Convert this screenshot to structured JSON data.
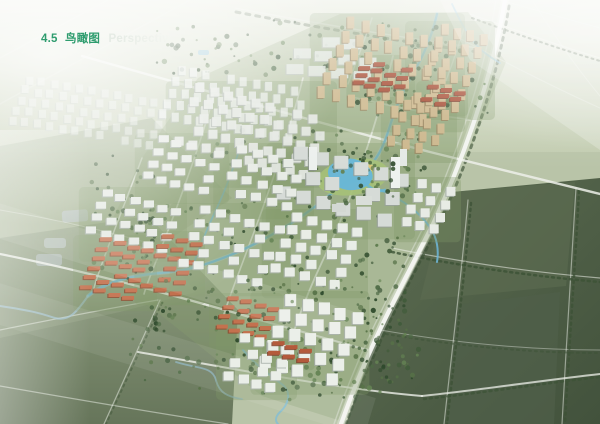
{
  "title": {
    "section": "4.5",
    "zh": "鸟瞰图",
    "en": "Perspective"
  },
  "image": {
    "description": "Hazy aerial bird's-eye perspective rendering of a new-town residential master plan: white and beige high-rise clusters, red- and salmon-roofed row houses, winding blue canals, a central civic core with lake park, a curved white bypass road, surrounded by green farmland with faint field roads"
  },
  "palette": {
    "title_green": "#2e9c6e",
    "title_en_gray": "#e2e9e2",
    "haze_white": "#ffffff",
    "field_light": "#c6d0b8",
    "field_medium": "#8a9a7c",
    "field_dark": "#4c5c45",
    "water_blue": "#6fb9dc",
    "road_white": "#edf0ea",
    "tree_green": "#4e6a45",
    "white_building": "#e7ebe5",
    "beige_building": "#cdb88d",
    "red_roof": "#a84f36",
    "salmon_roof": "#c4714e",
    "park_lawn": "#a6c178",
    "park_sand": "#d7c271"
  },
  "scene": {
    "tree_palette": [
      "#4e6a45",
      "#3f5a39",
      "#648253",
      "#2f4a2c",
      "#577247"
    ],
    "clusters": [
      {
        "name": "distant-city-west",
        "x": 26,
        "y": 76,
        "cols": 12,
        "rows": 5,
        "sx": 12.5,
        "sy": 10,
        "bw": 7,
        "bh": 8,
        "color": "#e9ede9",
        "shade": "#b6bfba",
        "op": 0.55,
        "rise": 0.18,
        "skip": 0.06,
        "lawn": false
      },
      {
        "name": "distant-city-east",
        "x": 178,
        "y": 66,
        "cols": 11,
        "rows": 5,
        "sx": 12.5,
        "sy": 11,
        "bw": 7,
        "bh": 9,
        "color": "#eaeeea",
        "shade": "#b2bbb5",
        "op": 0.75,
        "rise": 0.18,
        "skip": 0.08,
        "lawn": false
      },
      {
        "name": "industrial-sheds",
        "x": 300,
        "y": 34,
        "cols": 4,
        "rows": 3,
        "sx": 22,
        "sy": 15,
        "bw": 17,
        "bh": 10,
        "color": "#e2e7e1",
        "shade": "#b8c0ba",
        "op": 0.85,
        "rise": 0.12,
        "lawn": false
      },
      {
        "name": "beige-towers-north",
        "x": 348,
        "y": 16,
        "cols": 8,
        "rows": 6,
        "sx": 14.5,
        "sy": 14,
        "bw": 7,
        "bh": 12,
        "color": "#cdb88d",
        "shade": "#97815c",
        "op": 1
      },
      {
        "name": "redroof-rows-north",
        "x": 362,
        "y": 58,
        "cols": 4,
        "rows": 4,
        "sx": 13,
        "sy": 7.5,
        "bw": 11,
        "bh": 4,
        "color": "#a84f36",
        "shade": "#7c3a28",
        "op": 1
      },
      {
        "name": "beige-towers-east",
        "x": 442,
        "y": 24,
        "cols": 4,
        "rows": 6,
        "sx": 13,
        "sy": 13.5,
        "bw": 7,
        "bh": 11,
        "color": "#cdb88d",
        "shade": "#97815c",
        "op": 1
      },
      {
        "name": "redroof-rows-east",
        "x": 428,
        "y": 84,
        "cols": 3,
        "rows": 3,
        "sx": 13,
        "sy": 7,
        "bw": 11,
        "bh": 4,
        "color": "#a84f36",
        "shade": "#7c3a28",
        "op": 1
      },
      {
        "name": "beige-towers-mid",
        "x": 404,
        "y": 100,
        "cols": 4,
        "rows": 4,
        "sx": 13,
        "sy": 12,
        "bw": 7,
        "bh": 10,
        "color": "#cbb68b",
        "shade": "#97815c",
        "op": 1
      },
      {
        "name": "white-blocks-mid",
        "x": 196,
        "y": 84,
        "cols": 10,
        "rows": 5,
        "sx": 14,
        "sy": 13,
        "bw": 9,
        "bh": 9,
        "color": "#e3e7e1",
        "shade": "#aab2ac",
        "op": 0.95
      },
      {
        "name": "civic-core-blocks",
        "x": 294,
        "y": 146,
        "cols": 6,
        "rows": 3,
        "sx": 20,
        "sy": 20,
        "bw": 14,
        "bh": 13,
        "color": "#d6dbd7",
        "shade": "#99a19b",
        "op": 1
      },
      {
        "name": "white-res-a",
        "x": 158,
        "y": 136,
        "cols": 5,
        "rows": 4,
        "sx": 14,
        "sy": 12,
        "bw": 10,
        "bh": 7,
        "color": "#e5e9e3",
        "shade": "#a9b1ab",
        "op": 1
      },
      {
        "name": "white-res-b",
        "x": 238,
        "y": 146,
        "cols": 5,
        "rows": 4,
        "sx": 15,
        "sy": 13,
        "bw": 10,
        "bh": 8,
        "color": "#e7ebe5",
        "shade": "#a9b1ab",
        "op": 1
      },
      {
        "name": "white-res-c",
        "x": 102,
        "y": 190,
        "cols": 6,
        "rows": 4,
        "sx": 14,
        "sy": 12,
        "bw": 10,
        "bh": 7,
        "color": "#e5e9e3",
        "shade": "#a9b1ab",
        "op": 1
      },
      {
        "name": "salmon-rows-a",
        "x": 100,
        "y": 238,
        "cols": 4,
        "rows": 6,
        "sx": 14,
        "sy": 9.5,
        "bw": 12,
        "bh": 4,
        "color": "#c4714e",
        "shade": "#8f4a2f",
        "op": 1
      },
      {
        "name": "salmon-rows-b",
        "x": 162,
        "y": 234,
        "cols": 3,
        "rows": 6,
        "sx": 14,
        "sy": 9.8,
        "bw": 12,
        "bh": 4,
        "color": "#c06c49",
        "shade": "#8f4a2f",
        "op": 1
      },
      {
        "name": "white-res-d",
        "x": 200,
        "y": 206,
        "cols": 6,
        "rows": 5,
        "sx": 15,
        "sy": 13,
        "bw": 10,
        "bh": 8,
        "color": "#e7ebe5",
        "shade": "#a9b1ab",
        "op": 1
      },
      {
        "name": "white-res-e",
        "x": 292,
        "y": 212,
        "cols": 5,
        "rows": 5,
        "sx": 15,
        "sy": 13,
        "bw": 10,
        "bh": 9,
        "color": "#e9ede7",
        "shade": "#a9b1ab",
        "op": 1
      },
      {
        "name": "salmon-rows-c",
        "x": 228,
        "y": 296,
        "cols": 4,
        "rows": 4,
        "sx": 13.5,
        "sy": 9.5,
        "bw": 11,
        "bh": 4,
        "color": "#c4714e",
        "shade": "#8f4a2f",
        "op": 1
      },
      {
        "name": "white-towers-south",
        "x": 286,
        "y": 294,
        "cols": 5,
        "rows": 5,
        "sx": 16.5,
        "sy": 15.5,
        "bw": 11,
        "bh": 12,
        "color": "#ebefe9",
        "shade": "#a2aaa4",
        "op": 1
      },
      {
        "name": "white-res-f",
        "x": 240,
        "y": 334,
        "cols": 4,
        "rows": 4,
        "sx": 14,
        "sy": 12.5,
        "bw": 10,
        "bh": 9,
        "color": "#e9ede7",
        "shade": "#a9b1ab",
        "op": 1
      },
      {
        "name": "white-res-east",
        "x": 418,
        "y": 180,
        "cols": 3,
        "rows": 4,
        "sx": 14,
        "sy": 12.5,
        "bw": 9,
        "bh": 9,
        "color": "#e7ebe5",
        "shade": "#a9b1ab",
        "op": 1
      },
      {
        "name": "redroof-rows-south",
        "x": 272,
        "y": 342,
        "cols": 3,
        "rows": 2,
        "sx": 14,
        "sy": 8,
        "bw": 12,
        "bh": 4,
        "color": "#b45a3b",
        "shade": "#84402a",
        "op": 1
      }
    ],
    "tree_bands": [
      {
        "name": "north-green-belt",
        "x": 150,
        "y": 20,
        "w": 320,
        "h": 55,
        "n": 80
      },
      {
        "name": "west-fringe",
        "x": 90,
        "y": 155,
        "w": 70,
        "h": 120,
        "n": 45
      },
      {
        "name": "canal-park-corridor",
        "x": 330,
        "y": 145,
        "w": 80,
        "h": 55,
        "n": 30
      },
      {
        "name": "beige-greens",
        "x": 340,
        "y": 30,
        "w": 150,
        "h": 85,
        "n": 45
      },
      {
        "name": "mid-greens",
        "x": 190,
        "y": 130,
        "w": 160,
        "h": 40,
        "n": 30
      },
      {
        "name": "south-fringe",
        "x": 130,
        "y": 285,
        "w": 260,
        "h": 105,
        "n": 110
      },
      {
        "name": "east-fringe",
        "x": 352,
        "y": 235,
        "w": 60,
        "h": 150,
        "n": 60
      },
      {
        "name": "residential-greens",
        "x": 110,
        "y": 195,
        "w": 240,
        "h": 95,
        "n": 70
      },
      {
        "name": "core-greens",
        "x": 285,
        "y": 150,
        "w": 140,
        "h": 70,
        "n": 35
      },
      {
        "name": "canal-north",
        "x": 395,
        "y": 70,
        "w": 45,
        "h": 70,
        "n": 30
      },
      {
        "name": "bottom-tip",
        "x": 250,
        "y": 330,
        "w": 170,
        "h": 70,
        "n": 50
      },
      {
        "name": "south-fringe-pop",
        "x": 140,
        "y": 278,
        "w": 240,
        "h": 45,
        "n": 30,
        "layer": "front"
      },
      {
        "name": "park-edge-pop",
        "x": 320,
        "y": 158,
        "w": 90,
        "h": 45,
        "n": 18,
        "layer": "front"
      }
    ]
  }
}
